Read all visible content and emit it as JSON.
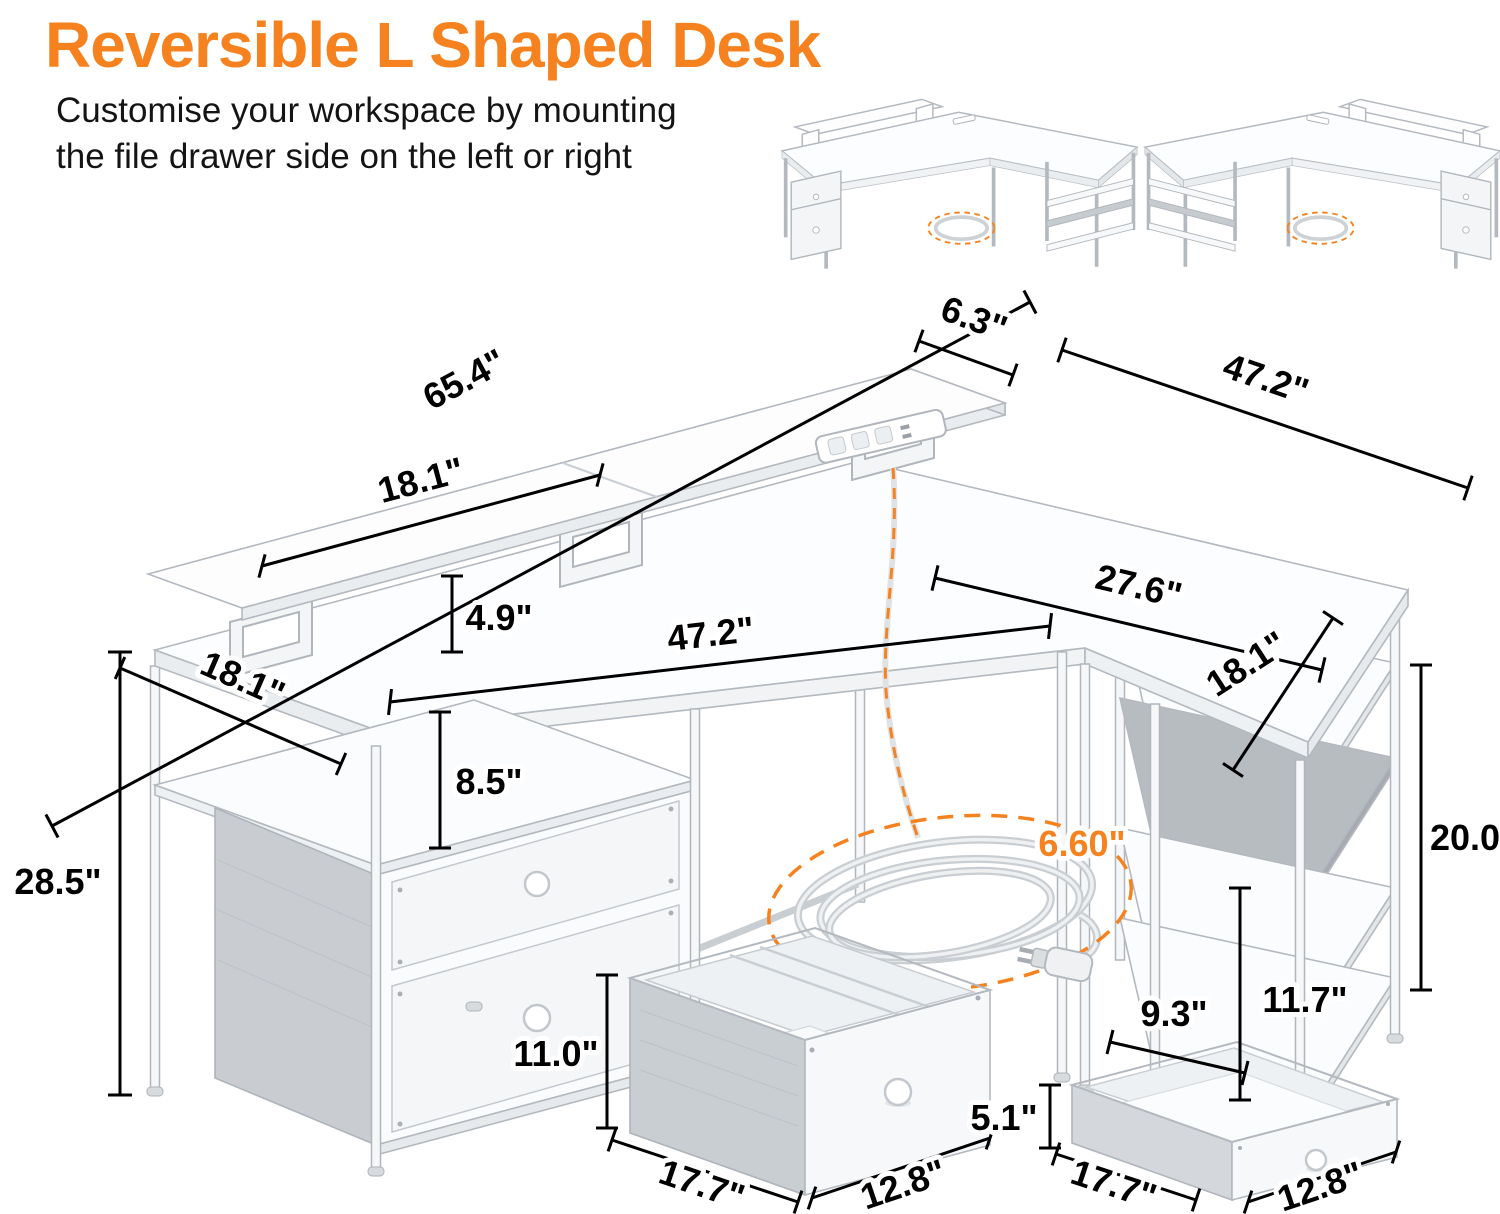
{
  "title": "Reversible L Shaped Desk",
  "subtitle_line1": "Customise your workspace by mounting",
  "subtitle_line2": "the file drawer side on the left or right",
  "colors": {
    "accent_orange": "#F5821F",
    "dimension_line": "#000000",
    "desk_outline": "#B3B9BF",
    "shelf_gray": "#B7BCC1",
    "fabric_gray": "#C9CED3"
  },
  "dimensions": {
    "top_total": "65.4\"",
    "monitor_stand_depth": "6.3\"",
    "right_desk_length": "47.2\"",
    "monitor_shelf_left": "18.1\"",
    "monitor_stand_height": "4.9\"",
    "main_desk_length": "47.2\"",
    "right_desk_inner": "27.6\"",
    "right_desk_depth": "18.1\"",
    "left_desk_depth": "18.1\"",
    "shelf_gap": "8.5\"",
    "desk_height": "28.5\"",
    "tower_height": "20.0\"",
    "tower_shelf_gap": "11.7\"",
    "bottom_shelf_depth": "9.3\"",
    "cable_length": "6.60\"",
    "file_drawer_height": "11.0\"",
    "file_drawer_width": "17.7\"",
    "file_drawer_depth": "12.8\"",
    "small_drawer_height": "5.1\"",
    "small_drawer_width": "17.7\"",
    "small_drawer_depth": "12.8\""
  }
}
